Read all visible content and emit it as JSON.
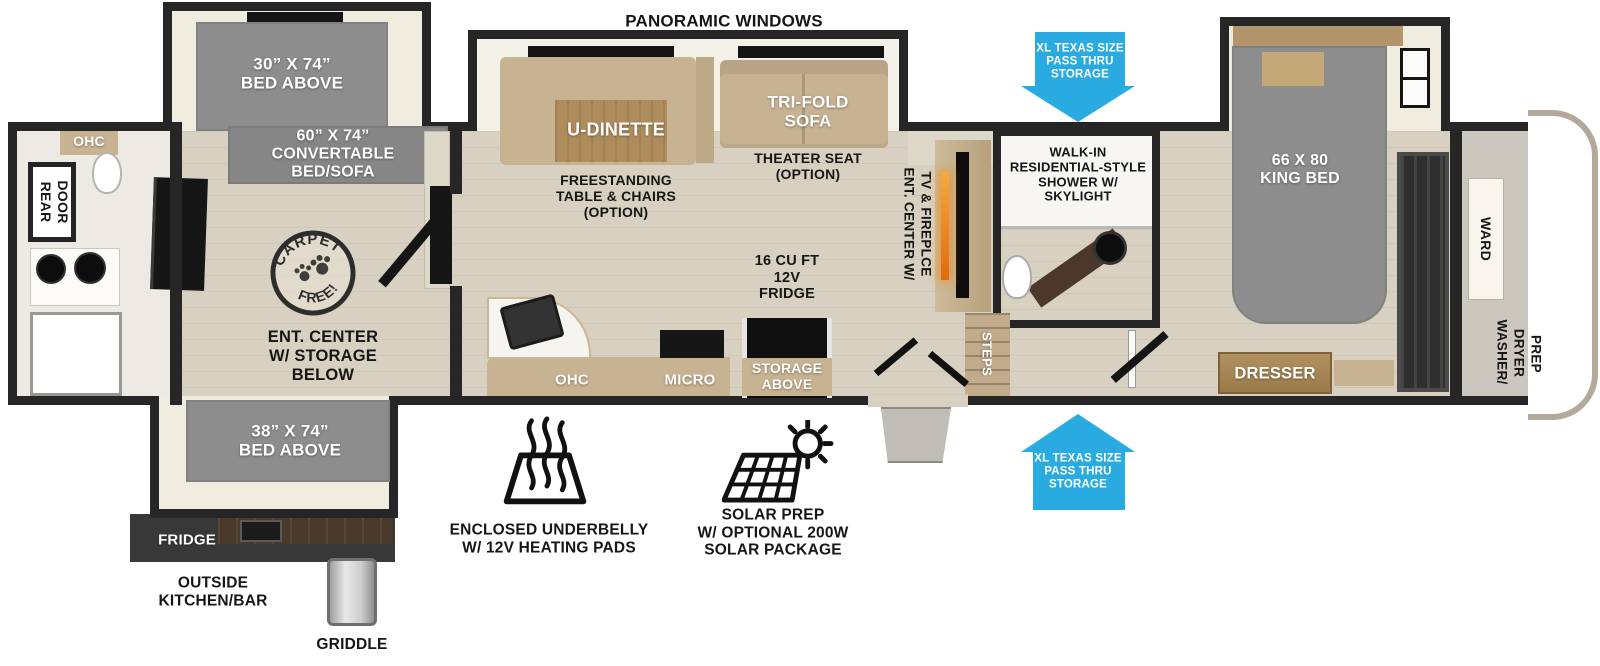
{
  "title": "PANORAMIC WINDOWS",
  "arrows": {
    "top": "XL TEXAS SIZE\nPASS THRU\nSTORAGE",
    "bottom": "XL TEXAS SIZE\nPASS THRU\nSTORAGE"
  },
  "rear_bath": {
    "ohc": "OHC",
    "rear_door": [
      "REAR",
      "DOOR"
    ]
  },
  "bunk_room": {
    "bed_above_top": "30” X 74”\nBED ABOVE",
    "convertible": "60” X 74”\nCONVERTABLE\nBED/SOFA",
    "carpet_free": [
      "CARPET",
      "FREE!"
    ],
    "ent_center": "ENT. CENTER\nW/ STORAGE\nBELOW",
    "bed_above_bottom": "38” X 74”\nBED ABOVE"
  },
  "outside_kitchen": {
    "fridge": "FRIDGE",
    "label": "OUTSIDE\nKITCHEN/BAR",
    "griddle": "GRIDDLE"
  },
  "living": {
    "u_dinette": "U-DINETTE",
    "freestanding": "FREESTANDING\nTABLE & CHAIRS\n(OPTION)",
    "tri_fold_sofa": "TRI-FOLD\nSOFA",
    "theater_seat": "THEATER SEAT\n(OPTION)",
    "ent_center": [
      "ENT. CENTER W/",
      "TV & FIREPLCE"
    ]
  },
  "kitchen": {
    "ohc": "OHC",
    "micro": "MICRO",
    "fridge": "16 CU FT\n12V\nFRIDGE",
    "storage_above": "STORAGE\nABOVE"
  },
  "bath": {
    "shower": "WALK-IN\nRESIDENTIAL-STYLE\nSHOWER W/\nSKYLIGHT",
    "steps": "STEPS"
  },
  "bedroom": {
    "king_bed": "66 X 80\nKING BED",
    "dresser": "DRESSER",
    "ward": "WARD",
    "washer_dryer_prep": [
      "WASHER/",
      "DRYER",
      "PREP"
    ]
  },
  "features": {
    "underbelly": "ENCLOSED UNDERBELLY\nW/ 12V HEATING PADS",
    "solar": "SOLAR PREP\nW/ OPTIONAL 200W\nSOLAR PACKAGE"
  },
  "colors": {
    "arrow_blue": "#29abe2",
    "wall_black": "#262626",
    "bed_gray": "#8d8d8d",
    "furniture_tan": "#c7b292",
    "fireplace_orange": "#e0731d"
  }
}
